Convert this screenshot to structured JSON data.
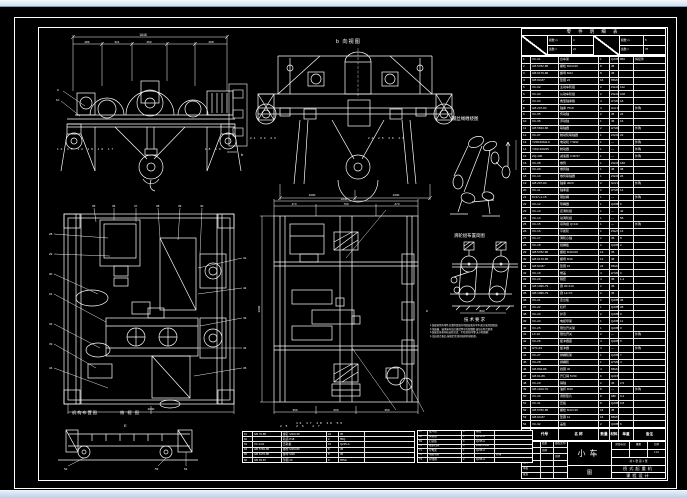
{
  "window": {
    "app": "CAD 图纸视图"
  },
  "views": {
    "front": {
      "dim_total": "1646",
      "dims": [
        "286",
        "321",
        "450",
        "268"
      ],
      "balloons_left": "12 13 14 15 16 17",
      "balloons_right": "18 19",
      "leader_a": "9",
      "leader_b": "10"
    },
    "side": {
      "label": "b 向视图",
      "marker": "b",
      "dims": [
        "1000",
        "1000"
      ],
      "balloons_left": "21 22 23",
      "balloons_right": "24 25 26 27"
    },
    "plan_left": {
      "caption1": "机构布置图",
      "caption2": "俯 视 图",
      "dim_bottom": "2000",
      "balloons_left": [
        "28",
        "29",
        "30",
        "31",
        "32",
        "33",
        "34"
      ],
      "balloons_top": [
        "35",
        "36",
        "37",
        "38",
        "39",
        "40"
      ],
      "balloons_right": [
        "41",
        "42",
        "43",
        "44",
        "45"
      ]
    },
    "plan_mid": {
      "dim_top_total": "1646",
      "dims_top": [
        "473",
        "700",
        "473"
      ],
      "dim_left": "2000",
      "dims_bottom": [
        "350",
        "600",
        "350"
      ],
      "marker": "c",
      "balloons_bottom": "46 47 48 49 50"
    },
    "elevation": {
      "label": "E",
      "balloons": [
        "52",
        "53",
        "54"
      ]
    }
  },
  "details": {
    "reeving": {
      "label": "钢丝绳缠绕图"
    },
    "pulleys": {
      "label": "滑轮组布置简图",
      "dim": "800"
    }
  },
  "notes": {
    "title": "技术要求",
    "lines": [
      "1.装配前所有零件应清除铁屑并用煤油清洗干净,配合面涂润滑油;",
      "2.减速器、轴承座内加注规定牌号的润滑脂,油位应符合要求;",
      "3.装配后各机构应运转灵活、平稳,制动可靠,无卡阻现象;",
      "4.试运转合格后,按规定涂漆并做好防锈处理。"
    ]
  },
  "band": {
    "left": {
      "rows": [
        [
          "模数 m",
          "4"
        ],
        [
          "齿数 z",
          "21"
        ]
      ]
    },
    "right": {
      "rows": [
        [
          "模数 m",
          "5"
        ],
        [
          "齿数 z",
          "78"
        ]
      ]
    }
  },
  "parts_table": {
    "title": "零 件 明 细 表",
    "header_row": [
      "序号",
      "代号",
      "名  称",
      "数量",
      "材料",
      "单重",
      "备注"
    ],
    "rows": [
      [
        "1",
        "XC-01",
        "台车架",
        "1",
        "Q235-A",
        "860",
        "焊接件"
      ],
      [
        "2",
        "GB 5782-86",
        "螺栓 M24×90",
        "8",
        "45",
        "",
        ""
      ],
      [
        "3",
        "GB 6170-86",
        "螺母 M24",
        "8",
        "45",
        "",
        ""
      ],
      [
        "4",
        "GB 93-87",
        "垫圈 24",
        "16",
        "65Mn",
        "",
        ""
      ],
      [
        "5",
        "XC-02",
        "主动车轮组",
        "2",
        "ZG430-640",
        "112",
        ""
      ],
      [
        "6",
        "XC-03",
        "从动车轮组",
        "2",
        "ZG430-640",
        "108",
        ""
      ],
      [
        "7",
        "XC-04",
        "角型轴承箱",
        "4",
        "HT200",
        "18",
        ""
      ],
      [
        "8",
        "GB 297-84",
        "轴承 7518",
        "4",
        "GCr15",
        "",
        "外购"
      ],
      [
        "9",
        "XC-05",
        "传动轴",
        "2",
        "45",
        "24",
        ""
      ],
      [
        "10",
        "XC-06",
        "浮动轴",
        "1",
        "45",
        "16",
        ""
      ],
      [
        "11",
        "GB 5843-86",
        "联轴器",
        "2",
        "HT200",
        "",
        "外购"
      ],
      [
        "12",
        "XC-07",
        "制动轮联轴器",
        "1",
        "ZG310-570",
        "22",
        ""
      ],
      [
        "13",
        "YZR160M2-6",
        "电动机 7.5kW",
        "1",
        "—",
        "",
        "外购"
      ],
      [
        "14",
        "YWZ-300/45",
        "制动器",
        "1",
        "—",
        "",
        "外购"
      ],
      [
        "15",
        "ZQ-400",
        "减速器 i=48.57",
        "1",
        "—",
        "",
        "外购"
      ],
      [
        "16",
        "XC-08",
        "卷筒",
        "1",
        "ZG310-570",
        "186",
        ""
      ],
      [
        "17",
        "XC-09",
        "卷筒轴",
        "1",
        "45",
        "38",
        ""
      ],
      [
        "18",
        "XC-10",
        "卷筒联轴器",
        "1",
        "ZG310-570",
        "26",
        ""
      ],
      [
        "19",
        "GB 297-84",
        "轴承 3620",
        "2",
        "GCr15",
        "",
        "外购"
      ],
      [
        "20",
        "XC-11",
        "轴承座",
        "2",
        "HT200",
        "14",
        ""
      ],
      [
        "21",
        "6×37+1-15",
        "钢丝绳",
        "1",
        "—",
        "",
        "外购"
      ],
      [
        "22",
        "XC-12",
        "导绳器",
        "1",
        "Q235-A",
        "6",
        ""
      ],
      [
        "23",
        "XC-13",
        "定滑轮组",
        "1",
        "—",
        "42",
        ""
      ],
      [
        "24",
        "XC-14",
        "动滑轮组",
        "1",
        "—",
        "58",
        ""
      ],
      [
        "25",
        "XC-15",
        "吊钩组 Q=10t",
        "1",
        "—",
        "",
        "外购"
      ],
      [
        "26",
        "XC-16",
        "平衡轮",
        "1",
        "ZG270-500",
        "12",
        ""
      ],
      [
        "27",
        "XC-17",
        "滑轮心轴",
        "2",
        "45",
        "8",
        ""
      ],
      [
        "28",
        "XC-18",
        "挡绳板",
        "2",
        "Q235-A",
        "2",
        ""
      ],
      [
        "29",
        "GB 5782-86",
        "螺栓 M16×60",
        "12",
        "45",
        "",
        ""
      ],
      [
        "30",
        "GB 6170-86",
        "螺母 M16",
        "12",
        "45",
        "",
        ""
      ],
      [
        "31",
        "GB 93-87",
        "垫圈 16",
        "24",
        "65Mn",
        "",
        ""
      ],
      [
        "32",
        "XC-19",
        "端盖",
        "4",
        "HT200",
        "3",
        ""
      ],
      [
        "33",
        "XC-20",
        "隔套",
        "4",
        "45",
        "1.2",
        ""
      ],
      [
        "34",
        "GB 1096-79",
        "键 20×110",
        "2",
        "45",
        "",
        ""
      ],
      [
        "35",
        "GB 1096-79",
        "键 14×70",
        "2",
        "45",
        "",
        ""
      ],
      [
        "36",
        "XC-21",
        "走台板",
        "2",
        "Q235-A",
        "46",
        ""
      ],
      [
        "37",
        "XC-22",
        "栏杆",
        "1",
        "Q235-A",
        "28",
        ""
      ],
      [
        "38",
        "XC-23",
        "护罩",
        "2",
        "Q235-A",
        "9",
        ""
      ],
      [
        "39",
        "XC-24",
        "电缆导架",
        "1",
        "Q235-A",
        "11",
        ""
      ],
      [
        "40",
        "XC-25",
        "限位开关架",
        "1",
        "Q235-A",
        "3",
        ""
      ],
      [
        "41",
        "LX-10",
        "限位开关",
        "2",
        "—",
        "",
        "外购"
      ],
      [
        "42",
        "XC-26",
        "缓冲器座",
        "4",
        "Q235-A",
        "5",
        ""
      ],
      [
        "43",
        "HT1-63",
        "缓冲器",
        "4",
        "—",
        "",
        "外购"
      ],
      [
        "44",
        "XC-27",
        "排绳轮架",
        "1",
        "Q235-A",
        "7",
        ""
      ],
      [
        "45",
        "XC-28",
        "排绳轮",
        "1",
        "HT200",
        "4",
        ""
      ],
      [
        "46",
        "GB 894-86",
        "挡圈 40",
        "4",
        "65Mn",
        "",
        ""
      ],
      [
        "47",
        "GB 91-86",
        "开口销 5×50",
        "6",
        "Q215",
        "",
        ""
      ],
      [
        "48",
        "XC-29",
        "销轴",
        "2",
        "45",
        "2.5",
        ""
      ],
      [
        "49",
        "GB 1160-79",
        "油杯 M10",
        "8",
        "—",
        "",
        "外购"
      ],
      [
        "50",
        "XC-30",
        "调整垫片",
        "8",
        "08F",
        "0.2",
        ""
      ],
      [
        "51",
        "XC-31",
        "压板",
        "8",
        "Q235-A",
        "0.8",
        ""
      ],
      [
        "52",
        "GB 5783-86",
        "螺栓 M12×30",
        "16",
        "45",
        "",
        ""
      ],
      [
        "53",
        "GB 93-87",
        "垫圈 12",
        "16",
        "65Mn",
        "",
        ""
      ],
      [
        "54",
        "XC-32",
        "盖板",
        "2",
        "Q235-A",
        "6",
        ""
      ]
    ]
  },
  "bottom_table_a": {
    "rows": [
      [
        "61",
        "GB 70-85",
        "螺钉 M10×30",
        "24",
        "35",
        ""
      ],
      [
        "62",
        "",
        "轨道 P18",
        "2",
        "55Q",
        ""
      ],
      [
        "63",
        "XC-3-01",
        "压轨板",
        "16",
        "Q235-A",
        ""
      ],
      [
        "64",
        "GB 5782-86",
        "螺栓 M20×80",
        "8",
        "45",
        ""
      ],
      [
        "65",
        "GB 6170-86",
        "螺母 M20",
        "8",
        "45",
        ""
      ],
      [
        "66",
        "GB 93-87",
        "垫圈 20",
        "8",
        "65Mn",
        ""
      ]
    ]
  },
  "bottom_table_b": {
    "rows": [
      [
        "67",
        "缓冲器",
        "4",
        "橡胶",
        ""
      ],
      [
        "68",
        "夹轨器",
        "2",
        "Q235-A",
        ""
      ],
      [
        "69",
        "扫轨板",
        "4",
        "Q235-A",
        ""
      ],
      [
        "70",
        "端梁挡块",
        "4",
        "ZG270-500",
        ""
      ],
      [
        "71",
        "导电架",
        "1",
        "Q235-A",
        ""
      ],
      [
        "72",
        "电缆卷筒",
        "1",
        "",
        "外购"
      ],
      [
        "73",
        "护线槽",
        "2",
        "Q235-A",
        ""
      ]
    ]
  },
  "title_block": {
    "sign_rows": [
      [
        "标记",
        "处数",
        "更改文件号"
      ],
      [
        "签字",
        "日期",
        ""
      ],
      [
        "设计",
        "",
        "日期"
      ],
      [
        "校对",
        "",
        ""
      ],
      [
        "审核",
        "",
        ""
      ],
      [
        "批准",
        "",
        ""
      ]
    ],
    "title_main": "小车",
    "title_sub": "图",
    "info_grid_r1": [
      "阶段标记",
      "重量",
      "比例"
    ],
    "info_grid_r2": [
      "",
      "",
      "1:10"
    ],
    "sheet_info": "共 1 张  第 1 张",
    "org1": "桥式起重机",
    "org2": "课程设计"
  },
  "misc": {
    "stray": "25    26    27"
  }
}
